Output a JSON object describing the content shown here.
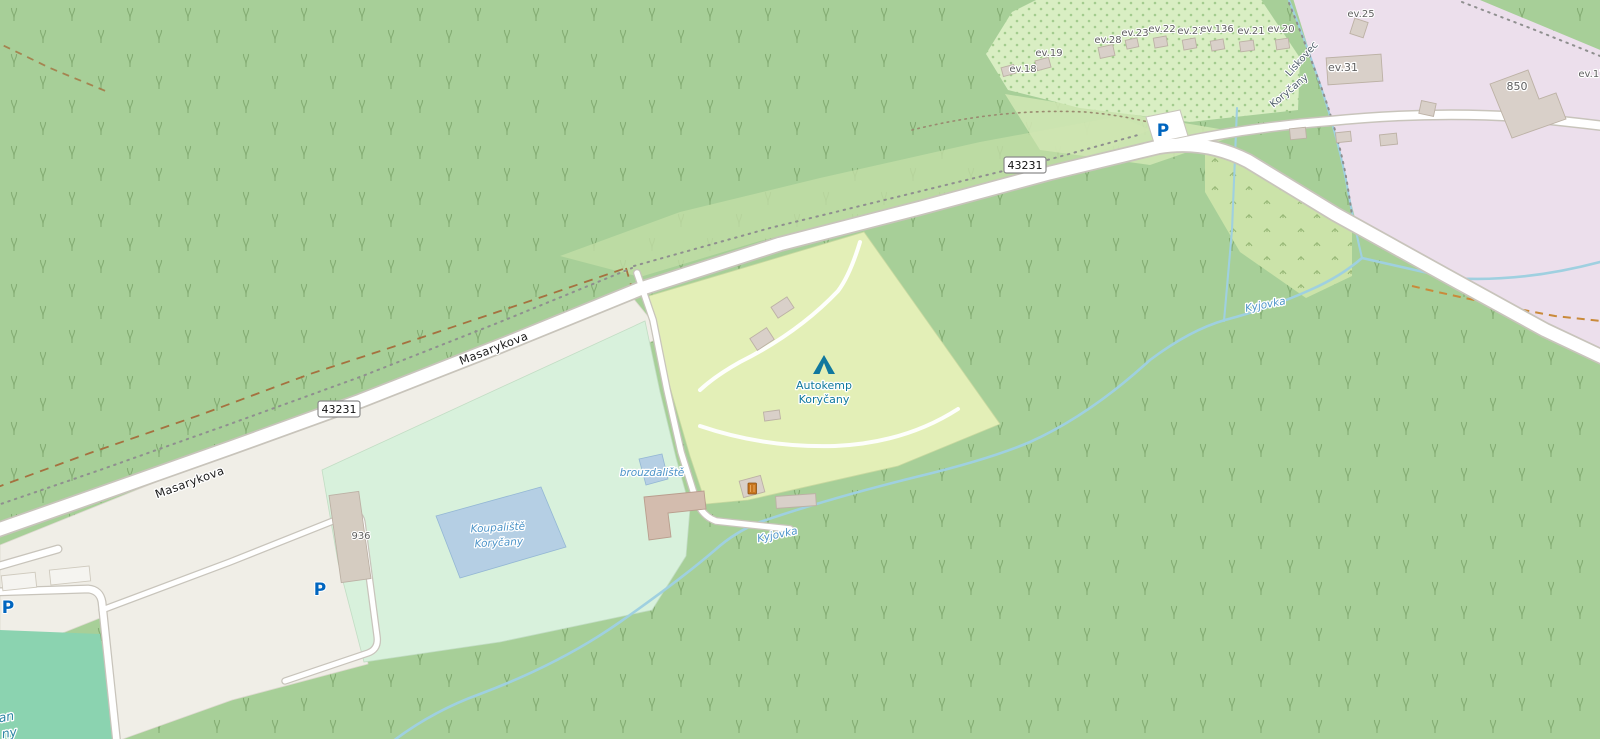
{
  "labels": {
    "road_ref": "43231",
    "street": "Masarykova",
    "parking": "P",
    "camp_line1": "Autokemp",
    "camp_line2": "Koryčany",
    "pool_line1": "Koupaliště",
    "pool_line2": "Koryčany",
    "paddling_pool": "brouzdaliště",
    "stream": "Kyjovka",
    "boundary_left": "Lískovec",
    "boundary_right": "Koryčany",
    "building_936": "936",
    "building_850": "850",
    "pitch_fragment_1": "an",
    "pitch_fragment_2": "ny",
    "houses": [
      "ev.18",
      "ev.19",
      "ev.28",
      "ev.23",
      "ev.22",
      "ev.27",
      "ev.136",
      "ev.21",
      "ev.20",
      "ev.25",
      "ev.31",
      "ev.17"
    ]
  },
  "icons": {
    "campsite": "tent-icon",
    "parking": "parking-icon",
    "waste": "waste-basket-icon"
  },
  "colors": {
    "forest": "#a7cf98",
    "tree_glyph": "#79a268",
    "orchard_bg": "#d9eec3",
    "scrub": "#cbe3a9",
    "meadow": "#c2dda6",
    "residential": "#ecdfec",
    "campsite": "#e3efb7",
    "park": "#d8f1dc",
    "pitch": "#8bd3b0",
    "paved": "#f0eee7",
    "water": "#9fd0e0",
    "water_fill": "#b5cfe4",
    "road_fill": "#ffffff",
    "road_casing": "#c8c4bb",
    "building": "#d9d0c9",
    "building_outline": "#bcb1a5",
    "track": "#a5713f",
    "track_orange": "#c98a3a",
    "boundary": "#8f8f8f",
    "street_label": "#1c1c1c",
    "water_label": "#4d94c8",
    "tourism_label": "#0f789e",
    "parking_blue": "#0065bf",
    "house_label": "#5f5f5f"
  }
}
